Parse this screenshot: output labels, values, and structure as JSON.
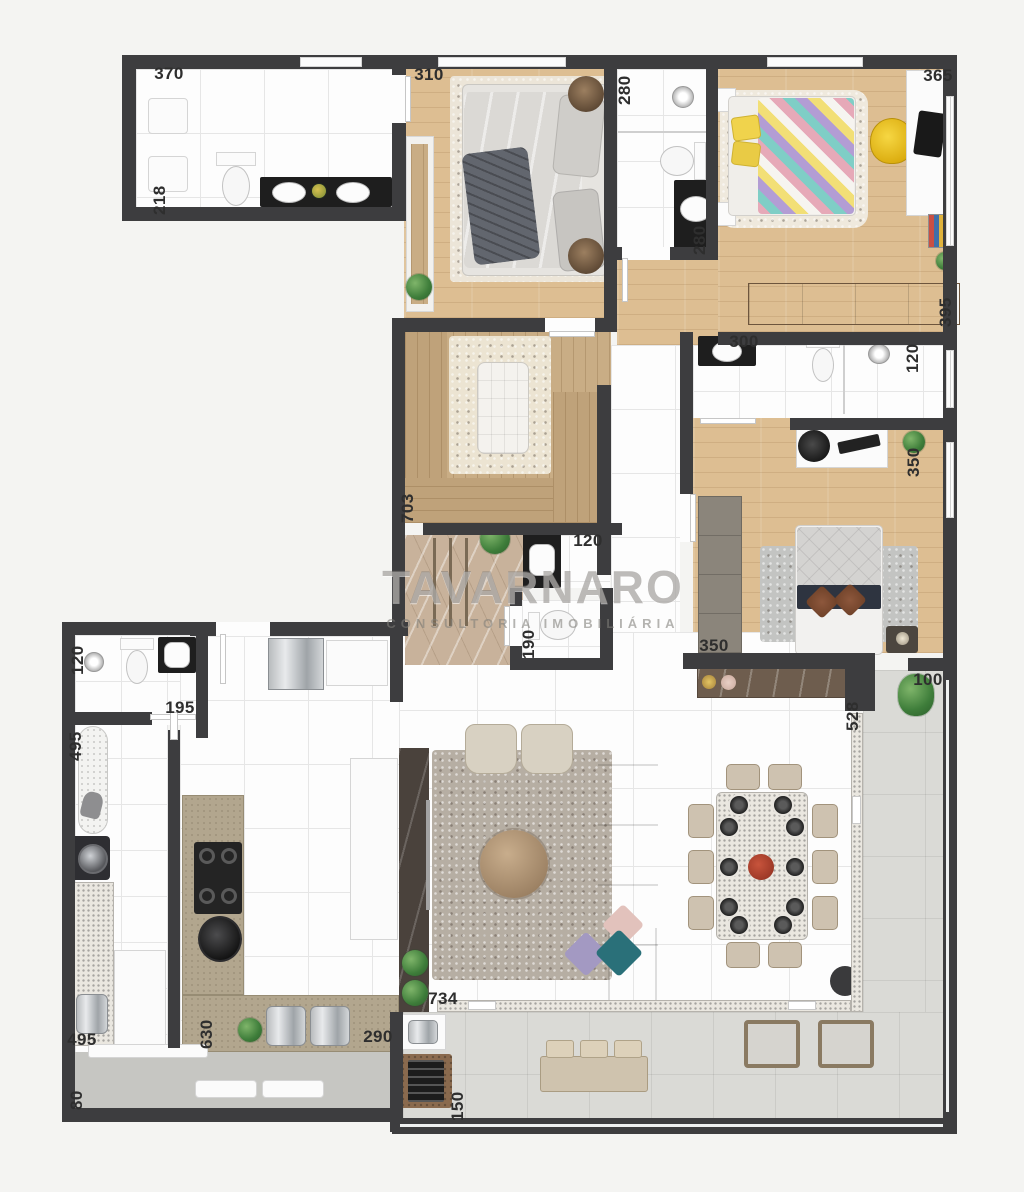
{
  "watermark": {
    "brand": "TAVARNARO",
    "tagline": "CONSULTORIA IMOBILIÁRIA"
  },
  "dims": {
    "bath_suite_width": "370",
    "bath_suite_depth": "218",
    "master_bedroom_width": "310",
    "bath2_depth": "280",
    "bath2_width": "280",
    "bedroom3_width": "365",
    "bedroom3_depth": "395",
    "bath3_width": "300",
    "bath3_depth": "120",
    "bedroom2_depth": "350",
    "bedroom2_width": "350",
    "closet_length": "703",
    "hall_width": "120",
    "wc_depth": "190",
    "service_bath_depth": "120",
    "service_bath_width": "195",
    "laundry_length": "495",
    "laundry_width": "495",
    "kitchen_length": "630",
    "kitchen_width": "290",
    "living_width": "734",
    "balcony_opening": "528",
    "balcony_stub": "100",
    "balcony_depth": "150",
    "corridor_width": "80"
  },
  "palette": {
    "wall": "#3d3d3f",
    "wood_floor": "#ddbe92",
    "tile_floor": "#fdfdfd",
    "marble_hall": "#c8b29b",
    "balcony_floor": "#dadad6",
    "kitchen_counter": "#b2a68e",
    "granite_border": "#eae7e0",
    "accent_yellow": "#f2c51d",
    "sofa": "#b7afa4",
    "pillow_teal": "#2a7079",
    "pillow_purple": "#a399c2",
    "pillow_pink": "#e2c2bc",
    "centerpiece_red": "#a83a28"
  }
}
